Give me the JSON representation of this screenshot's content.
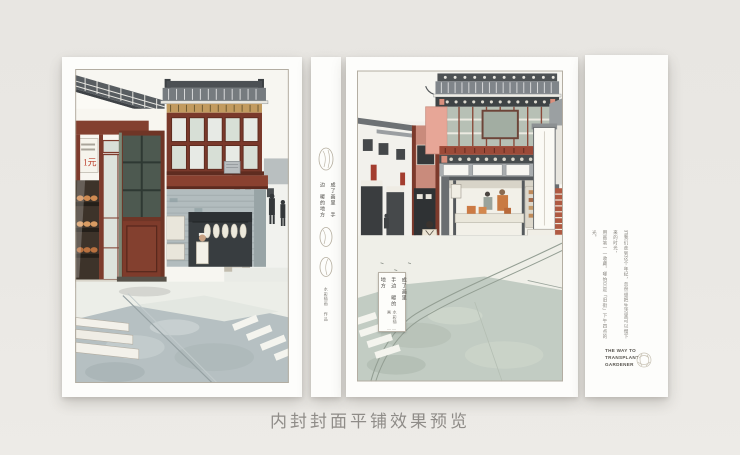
{
  "caption": "内封封面平铺效果预览",
  "title": {
    "columns": [
      "成了画里",
      "手边",
      "暖的地方"
    ]
  },
  "credit": {
    "line": "水彩插画",
    "suffix": "作品",
    "dash": "——"
  },
  "shop_sign": {
    "text": "1元"
  },
  "flap": {
    "paragraph_columns": [
      "当我们走到这个年纪，忽然想把生活里可以慢下来的时光，",
      "用画笔一一收藏，哪怕只是「旧街」下午四点的光。"
    ],
    "english_lines": [
      "THE WAY TO",
      "TRANSPLANT",
      "GARDENER"
    ]
  },
  "colors": {
    "background": "#e9e7e3",
    "page_white": "#fdfdfb",
    "maroon_wood": "#7d3b2c",
    "salmon_pink": "#e7a697",
    "dusty_rose": "#c98b7c",
    "roof_gray": "#80858a",
    "brick_gray_wall": "#b2bcbe",
    "road_wash_left": "#b6c0c2",
    "road_wash_right": "#c2ccc3",
    "bun_tan": "#cf8b52",
    "red_sign": "#a33d2f",
    "caption_text": "#8f8c88"
  }
}
